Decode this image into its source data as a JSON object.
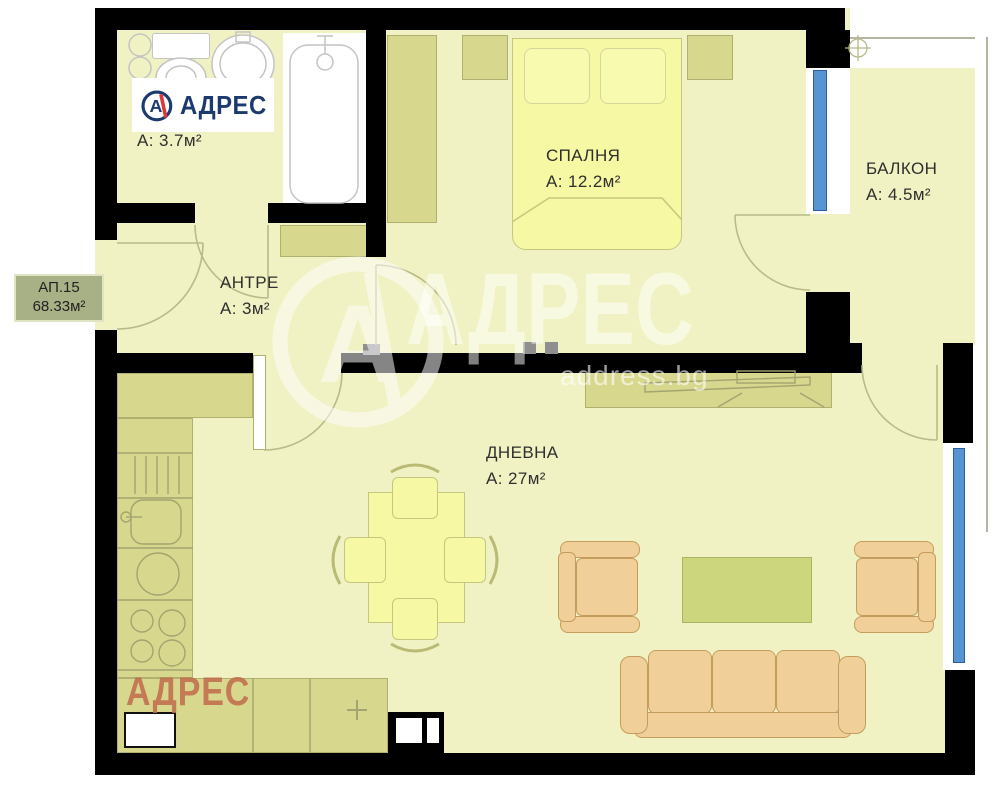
{
  "badge": {
    "id": "АП.15",
    "area": "68.33м²"
  },
  "rooms": {
    "bathroom": {
      "area_label": "А: 3.7м²"
    },
    "bedroom": {
      "name": "СПАЛНЯ",
      "area_label": "А: 12.2м²"
    },
    "balcony": {
      "name": "БАЛКОН",
      "area_label": "А: 4.5м²"
    },
    "hallway": {
      "name": "АНТРЕ",
      "area_label": "А: 3м²"
    },
    "living_room": {
      "name": "ДНЕВНА",
      "area_label": "А: 27м²"
    }
  },
  "branding": {
    "logo_text": "АДРЕС",
    "logo_letter": "А",
    "watermark_letter": "А",
    "watermark_text": "АДРЕС",
    "watermark_domain": "address.bg",
    "corner_watermark": "АДРЕС"
  },
  "colors": {
    "wall": "#000000",
    "floor": "#f1f2c3",
    "cabinet_olive": "#d7d88d",
    "furniture_yellow": "#f6f8a3",
    "upholstery_tan": "#f0d098",
    "coffee_table_green": "#ccd77d",
    "window_glass_blue": "#5694d2",
    "logo_navy": "#1d3a6e",
    "logo_red": "#dc3838",
    "corner_watermark_rust": "#bf6a4b"
  }
}
